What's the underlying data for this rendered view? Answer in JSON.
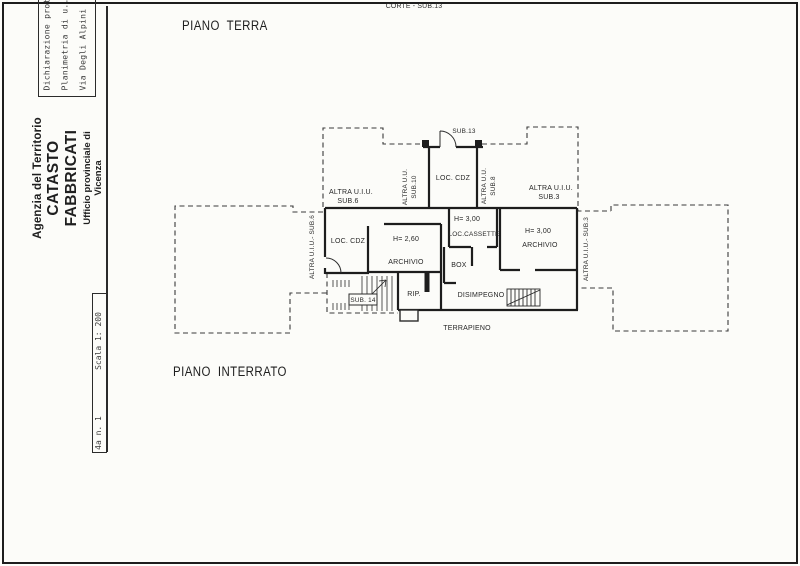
{
  "page": {
    "corte_label": "CORTE - SUB.13",
    "floor_top_label": "PIANO TERRA",
    "floor_bottom_label": "PIANO INTERRATO"
  },
  "sidebar": {
    "stamp_lines": [
      "Dichiarazione prot",
      "Planimetria di u..",
      "Via Degli Alpini"
    ],
    "agency_line1": "Agenzia del Territorio",
    "agency_line2": "CATASTO FABBRICATI",
    "agency_line3": "Ufficio provinciale di",
    "agency_line4": "Vicenza",
    "scale_label": "Scala 1: 200",
    "sheet_label": "4a n. 1"
  },
  "plan": {
    "labels": {
      "sub13": "SUB.13",
      "loc_cdz_top": "LOC. CDZ",
      "loc_cdz_left": "LOC. CDZ",
      "altra_sub6_line1": "ALTRA U.I.U.",
      "altra_sub6_line2": "SUB.6",
      "altra_sub3_line1": "ALTRA U.I.U.",
      "altra_sub3_line2": "SUB.3",
      "altra_sub10_line1": "ALTRA U.U.",
      "altra_sub10_line2": "SUB.10",
      "altra_sub8_line1": "ALTRA U.U.",
      "altra_sub8_line2": "SUB.8",
      "altra_sub6_side": "ALTRA U.I.U.- SUB.6",
      "altra_sub3_side": "ALTRA U.I.U.- SUB.3",
      "h_260": "H= 2,60",
      "archivio_center": "ARCHIVIO",
      "h_300_cassette": "H= 3,00",
      "loc_cassette": "LOC.CASSETTE",
      "box": "BOX",
      "h_300_archivio": "H= 3,00",
      "archivio_right": "ARCHIVIO",
      "rip": "RIP.",
      "disimpegno": "DISIMPEGNO",
      "sub14": "SUB. 14",
      "terrapieno": "TERRAPIENO"
    }
  },
  "colors": {
    "ink": "#222222",
    "wall_line": "#1d1d1d",
    "paper": "#fcfcf9"
  }
}
